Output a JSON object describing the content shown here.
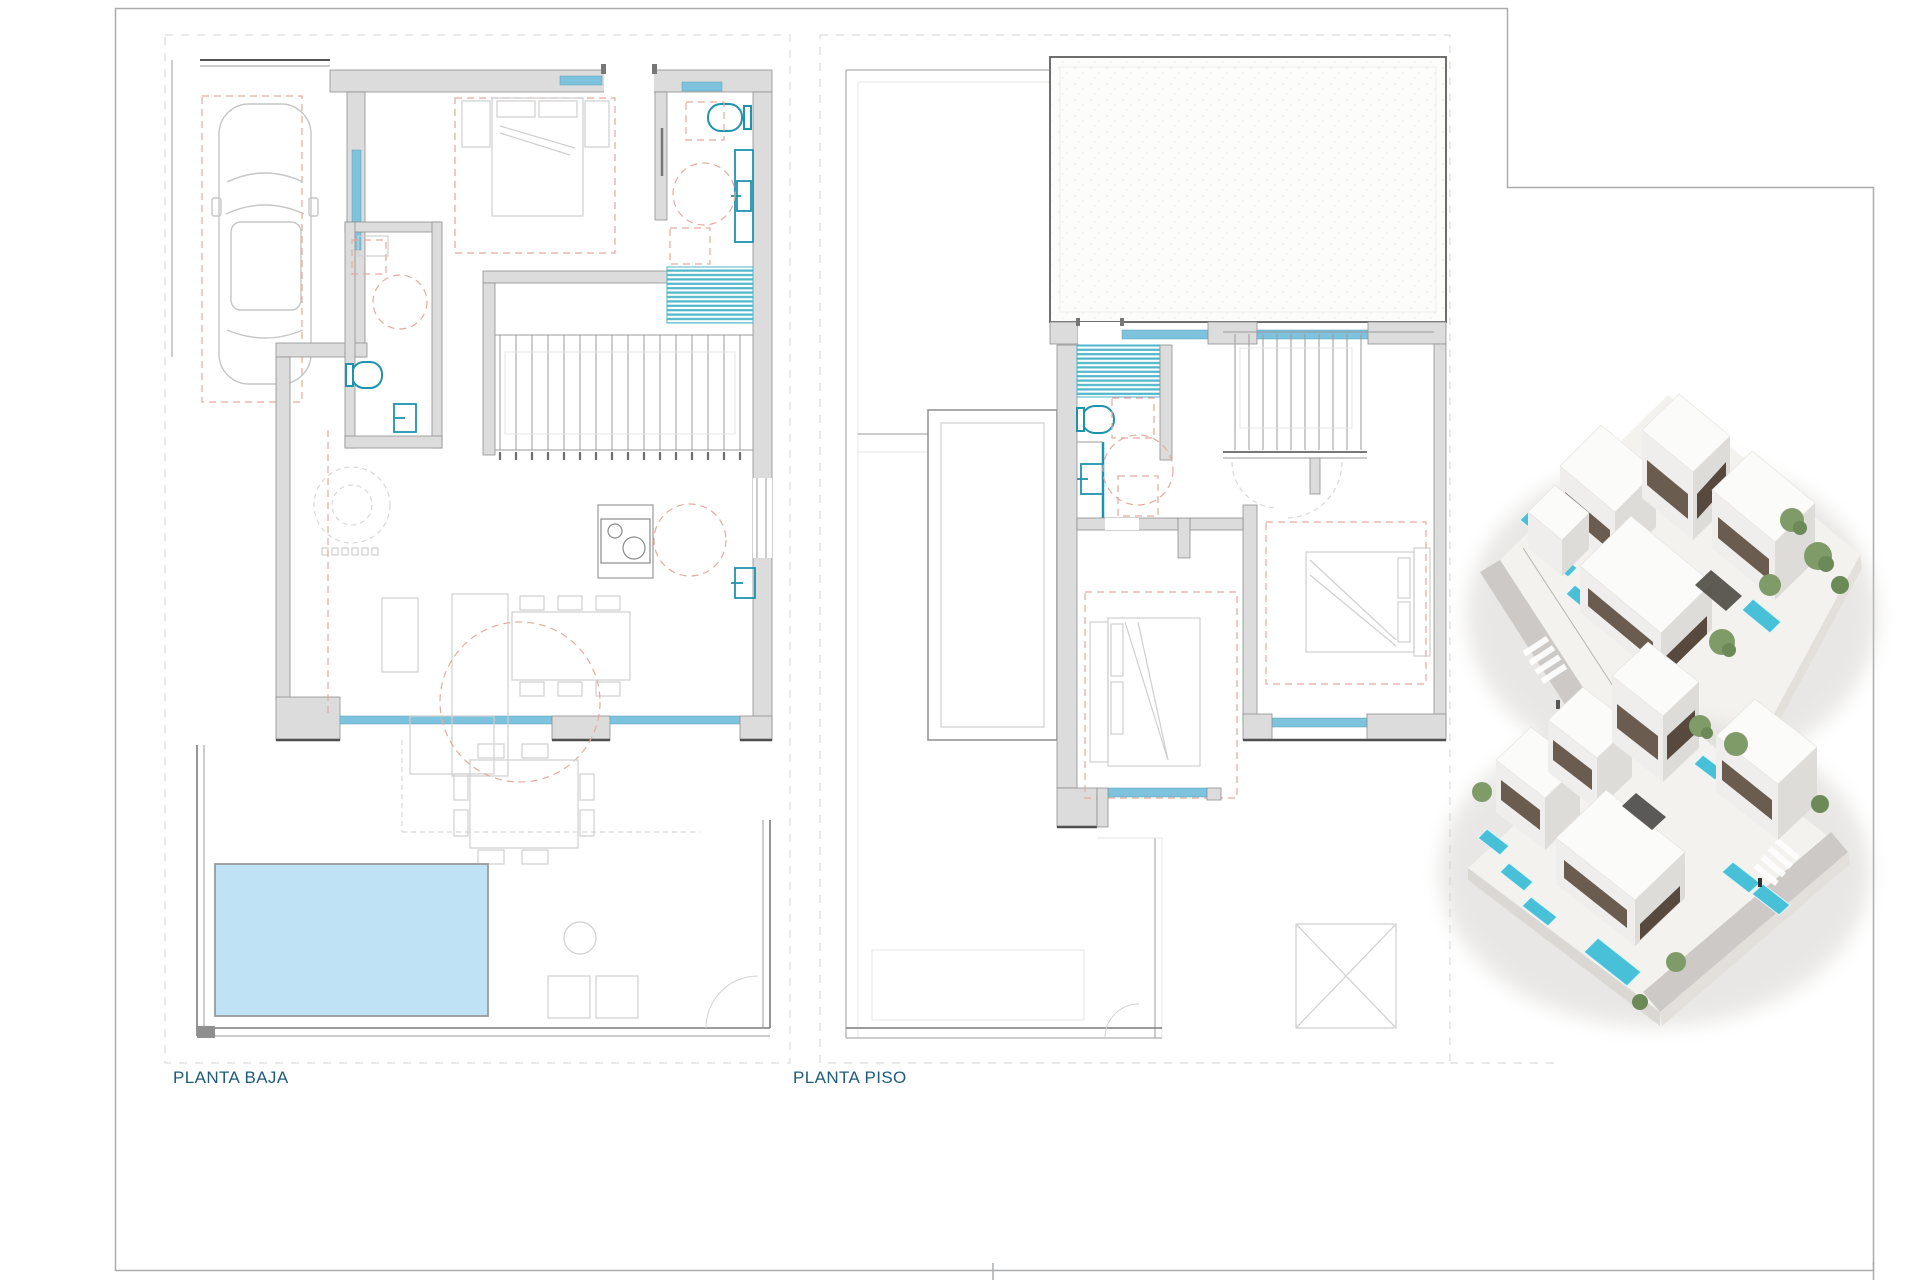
{
  "sheet": {
    "kind": "architectural floor plan sheet",
    "floors": 2,
    "renders": 2
  },
  "labels": {
    "ground_floor": "PLANTA BAJA",
    "first_floor": "PLANTA PISO"
  },
  "colors": {
    "label_text": "#1e5b7a",
    "frame": "#a9adb0",
    "wall_fill": "#dcdcdc",
    "wall_stroke": "#8f8f8f",
    "window_blue": "#7ec3de",
    "fixture_teal": "#1d93ad",
    "shower_stripe": "#4db6cb",
    "pool_fill": "#bfe3f4",
    "dashed_red": "#e3aba0",
    "dashed_gray": "#d8d8d6",
    "render_pool": "#48c1d8",
    "render_tree": "#7f9b68",
    "render_road": "#ccc9c6"
  }
}
